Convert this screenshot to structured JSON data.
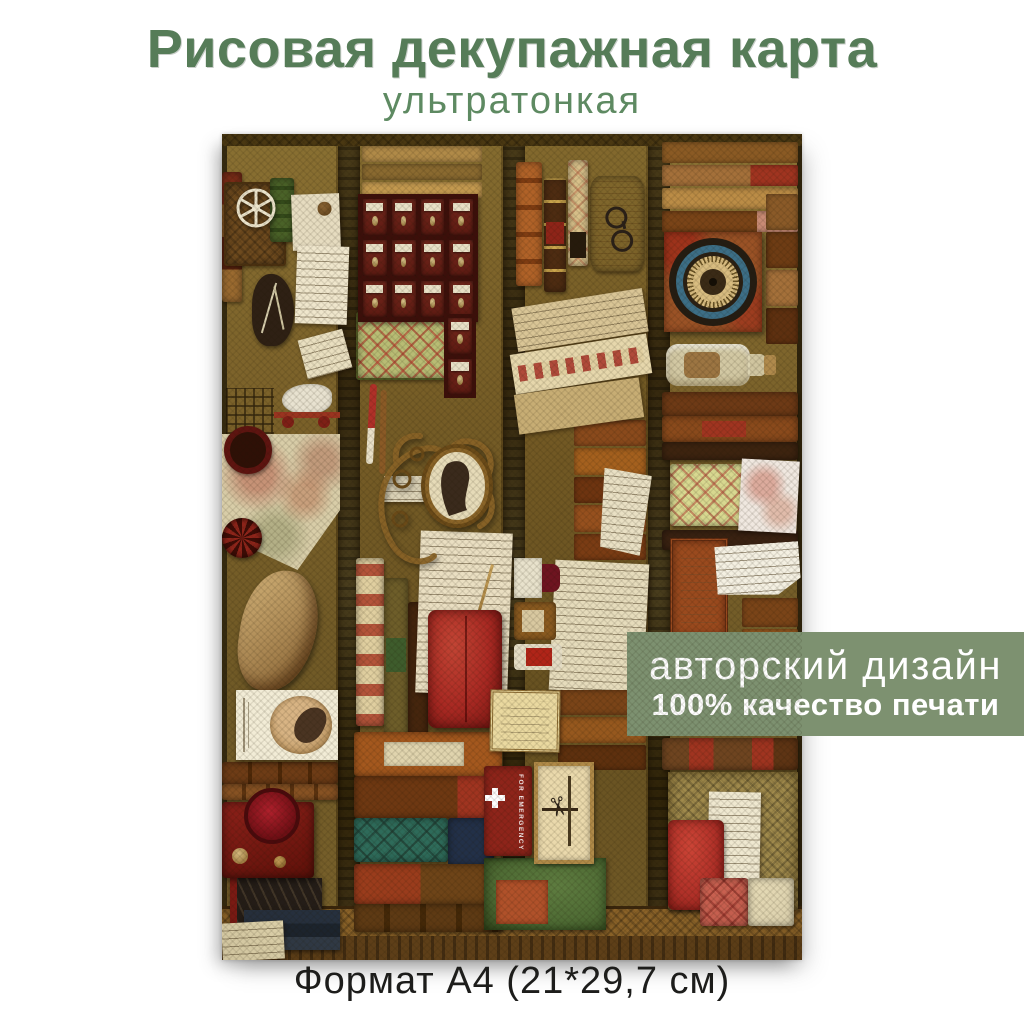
{
  "poster": {
    "title": "Рисовая декупажная карта",
    "subtitle": "ультратонкая",
    "banner": {
      "line1": "авторский дизайн",
      "line2": "100% качество печати"
    },
    "format_caption": "Формат А4 (21*29,7 см)"
  },
  "collage": {
    "emergency_label": "FOR EMERGENCY"
  },
  "colors": {
    "page_bg": "#ffffff",
    "title_green": "#567c58",
    "subtitle_green": "#5e8a62",
    "banner_green": "#7d9170",
    "banner_text": "#ffffff",
    "caption_color": "#1d1d1b",
    "photo_base": "#6b531f",
    "cabinet_maroon": "#5c1a12",
    "dial_blue": "#3c6e86",
    "velvet_red": "#a82822",
    "emergency_red": "#8e241a"
  }
}
